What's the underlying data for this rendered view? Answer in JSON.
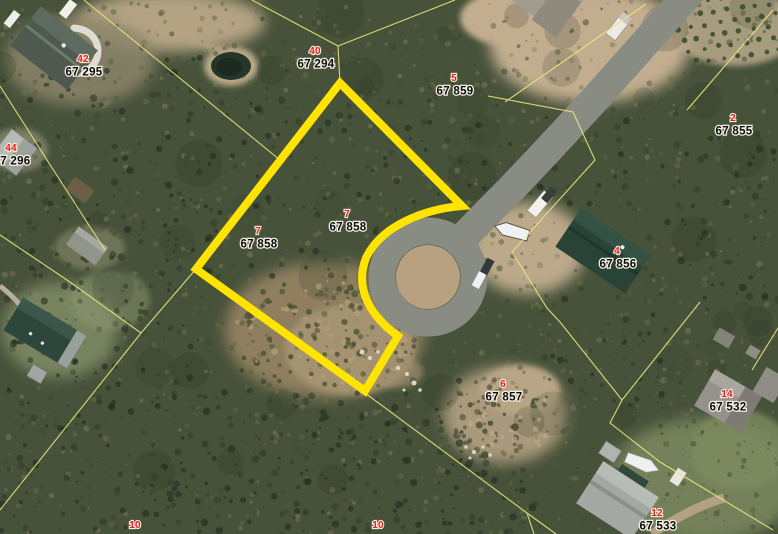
{
  "map": {
    "highlight_color": "#ffe400",
    "parcel_line_color": "#ece77f",
    "lot_number_color": "#e41e1e",
    "parcel_id_color": "#0b0b0b",
    "selected_parcel": {
      "lot": "7",
      "id": "67 858"
    },
    "labels": [
      {
        "lot": "42",
        "id": "67 295",
        "x": 83,
        "y": 62
      },
      {
        "lot": "44",
        "id": "67 296",
        "x": 11,
        "y": 151
      },
      {
        "lot": "40",
        "id": "67 294",
        "x": 315,
        "y": 54
      },
      {
        "lot": "5",
        "id": "67 859",
        "x": 454,
        "y": 81
      },
      {
        "lot": "2",
        "id": "67 855",
        "x": 733,
        "y": 121
      },
      {
        "lot": "7",
        "id": "67 858",
        "x": 258,
        "y": 234
      },
      {
        "lot": "7",
        "id": "67 858",
        "x": 347,
        "y": 217
      },
      {
        "lot": "4",
        "id": "67 856",
        "x": 617,
        "y": 254
      },
      {
        "lot": "6",
        "id": "67 857",
        "x": 503,
        "y": 387
      },
      {
        "lot": "14",
        "id": "67 532",
        "x": 727,
        "y": 397
      },
      {
        "lot": "12",
        "id": "67 533",
        "x": 657,
        "y": 516
      },
      {
        "lot": "10",
        "id": "",
        "x": 135,
        "y": 528
      },
      {
        "lot": "10",
        "id": "",
        "x": 378,
        "y": 528
      }
    ]
  }
}
